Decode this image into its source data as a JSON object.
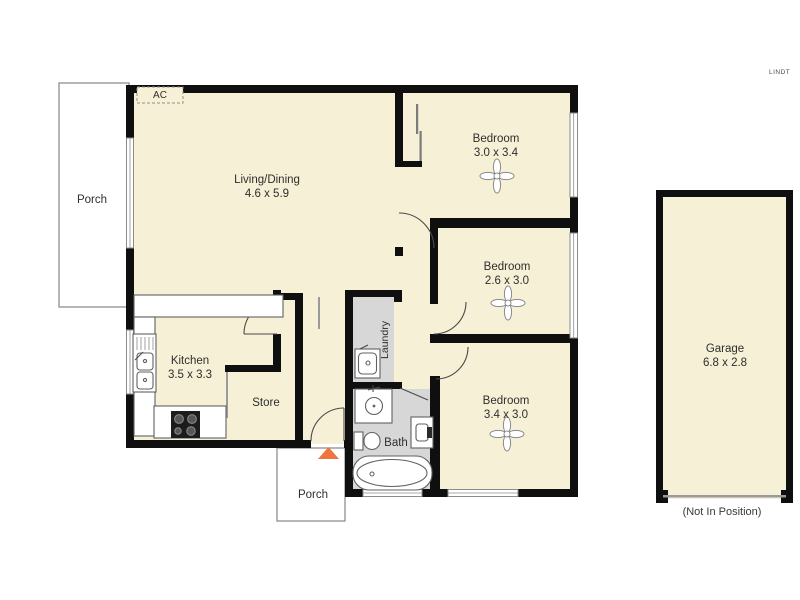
{
  "plan_title": "Residential floor plan",
  "rooms": {
    "living": {
      "name": "Living/Dining",
      "dims": "4.6 x 5.9"
    },
    "bedroom1": {
      "name": "Bedroom",
      "dims": "3.0 x 3.4"
    },
    "bedroom2": {
      "name": "Bedroom",
      "dims": "2.6 x 3.0"
    },
    "bedroom3": {
      "name": "Bedroom",
      "dims": "3.4 x 3.0"
    },
    "kitchen": {
      "name": "Kitchen",
      "dims": "3.5 x 3.3"
    },
    "store": {
      "name": "Store"
    },
    "laundry": {
      "name": "Laundry"
    },
    "bath": {
      "name": "Bath"
    },
    "porch_left": {
      "name": "Porch"
    },
    "porch_bottom": {
      "name": "Porch"
    },
    "garage": {
      "name": "Garage",
      "dims": "6.8 x 2.8",
      "note": "(Not In Position)"
    }
  },
  "annotations": {
    "ac_unit": "AC",
    "watermark": "LINDT"
  },
  "colors": {
    "room_fill": "#f6f0d6",
    "wall": "#0f0f0f",
    "wet_area_floor": "#d7d7d7",
    "entry_marker": "#ee7440"
  }
}
